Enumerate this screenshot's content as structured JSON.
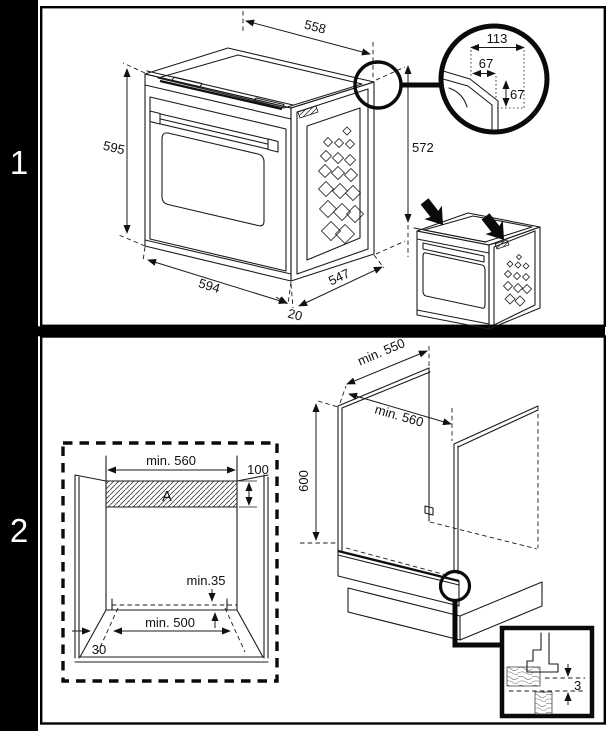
{
  "figure": {
    "line_color": "#1b1b1b",
    "bg_color": "#ffffff",
    "sidebar_color": "#000000"
  },
  "step1": {
    "index": "1",
    "oven_dims": {
      "top_width": "558",
      "front_height": "595",
      "bottom_width": "594",
      "bottom_offset": "20",
      "bottom_depth": "547",
      "rear_height": "572"
    },
    "corner_detail": {
      "total_width": "113",
      "inner_width": "67",
      "inner_height": "67"
    }
  },
  "step2": {
    "index": "2",
    "front_view": {
      "niche_width": "min. 560",
      "top_clearance": "100",
      "shelf_label": "A",
      "rear_clearance": "min.35",
      "base_width": "min. 500",
      "plinth_recess": "30"
    },
    "iso_view": {
      "top_depth": "min. 550",
      "niche_width": "min. 560",
      "niche_height": "600"
    },
    "foot_detail": {
      "gap": "3"
    }
  }
}
